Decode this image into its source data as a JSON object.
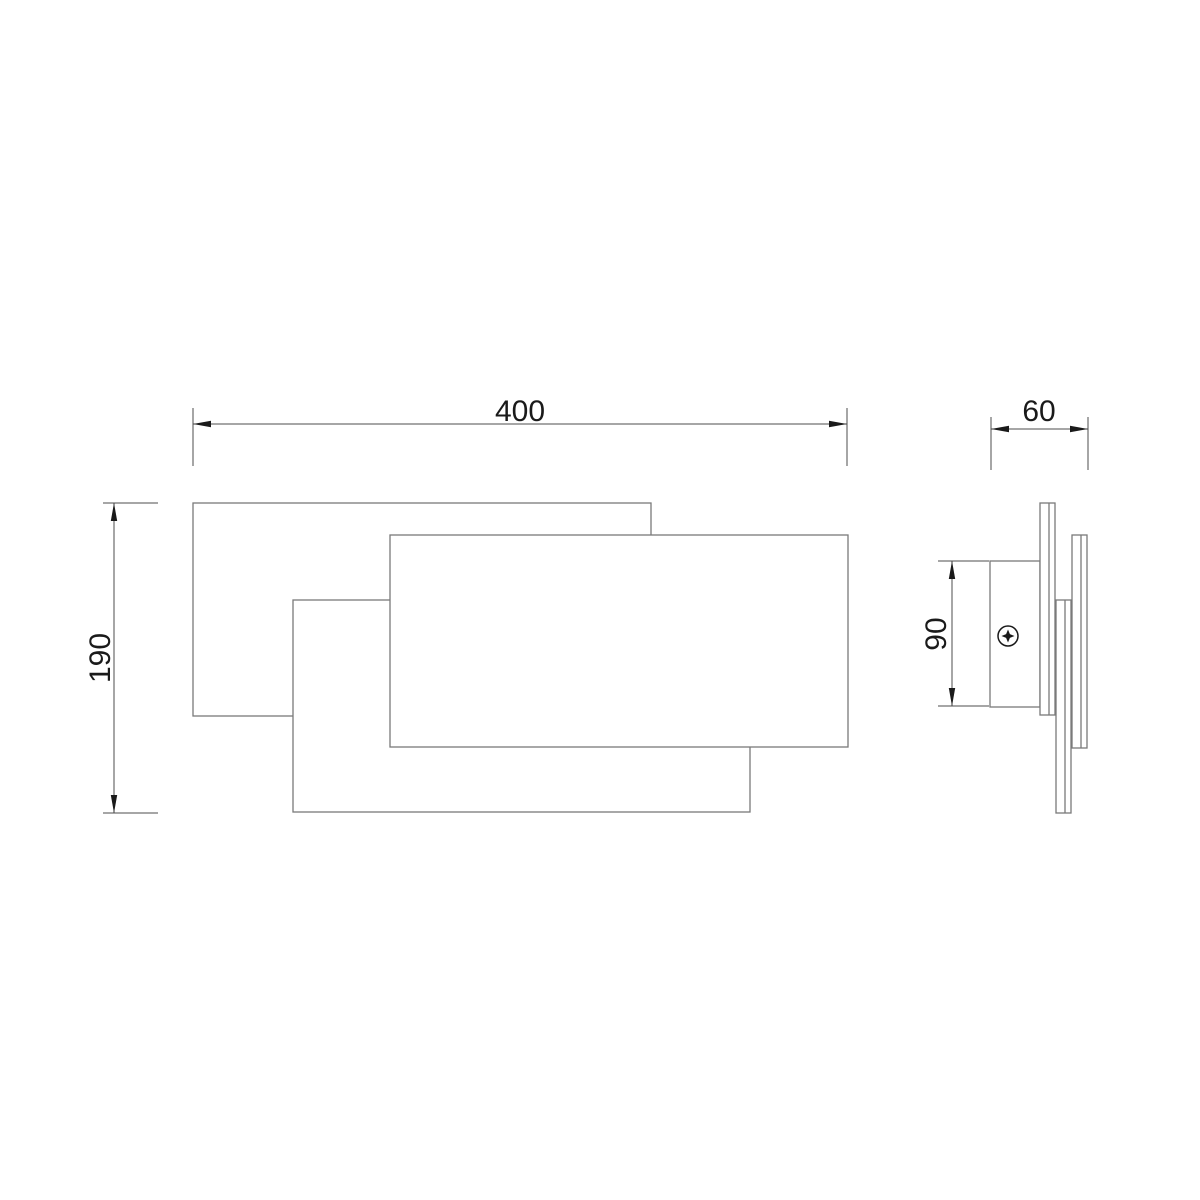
{
  "dimensions": {
    "front_width": "400",
    "front_height": "190",
    "side_depth": "60",
    "side_bracket_height": "90"
  },
  "icons": {
    "screw": "phillips-screw-head-icon"
  },
  "colors": {
    "background": "#ffffff",
    "outline": "#7a7a7a",
    "dimension_line": "#4d4d4d",
    "accent_text": "#1a1a1a"
  }
}
